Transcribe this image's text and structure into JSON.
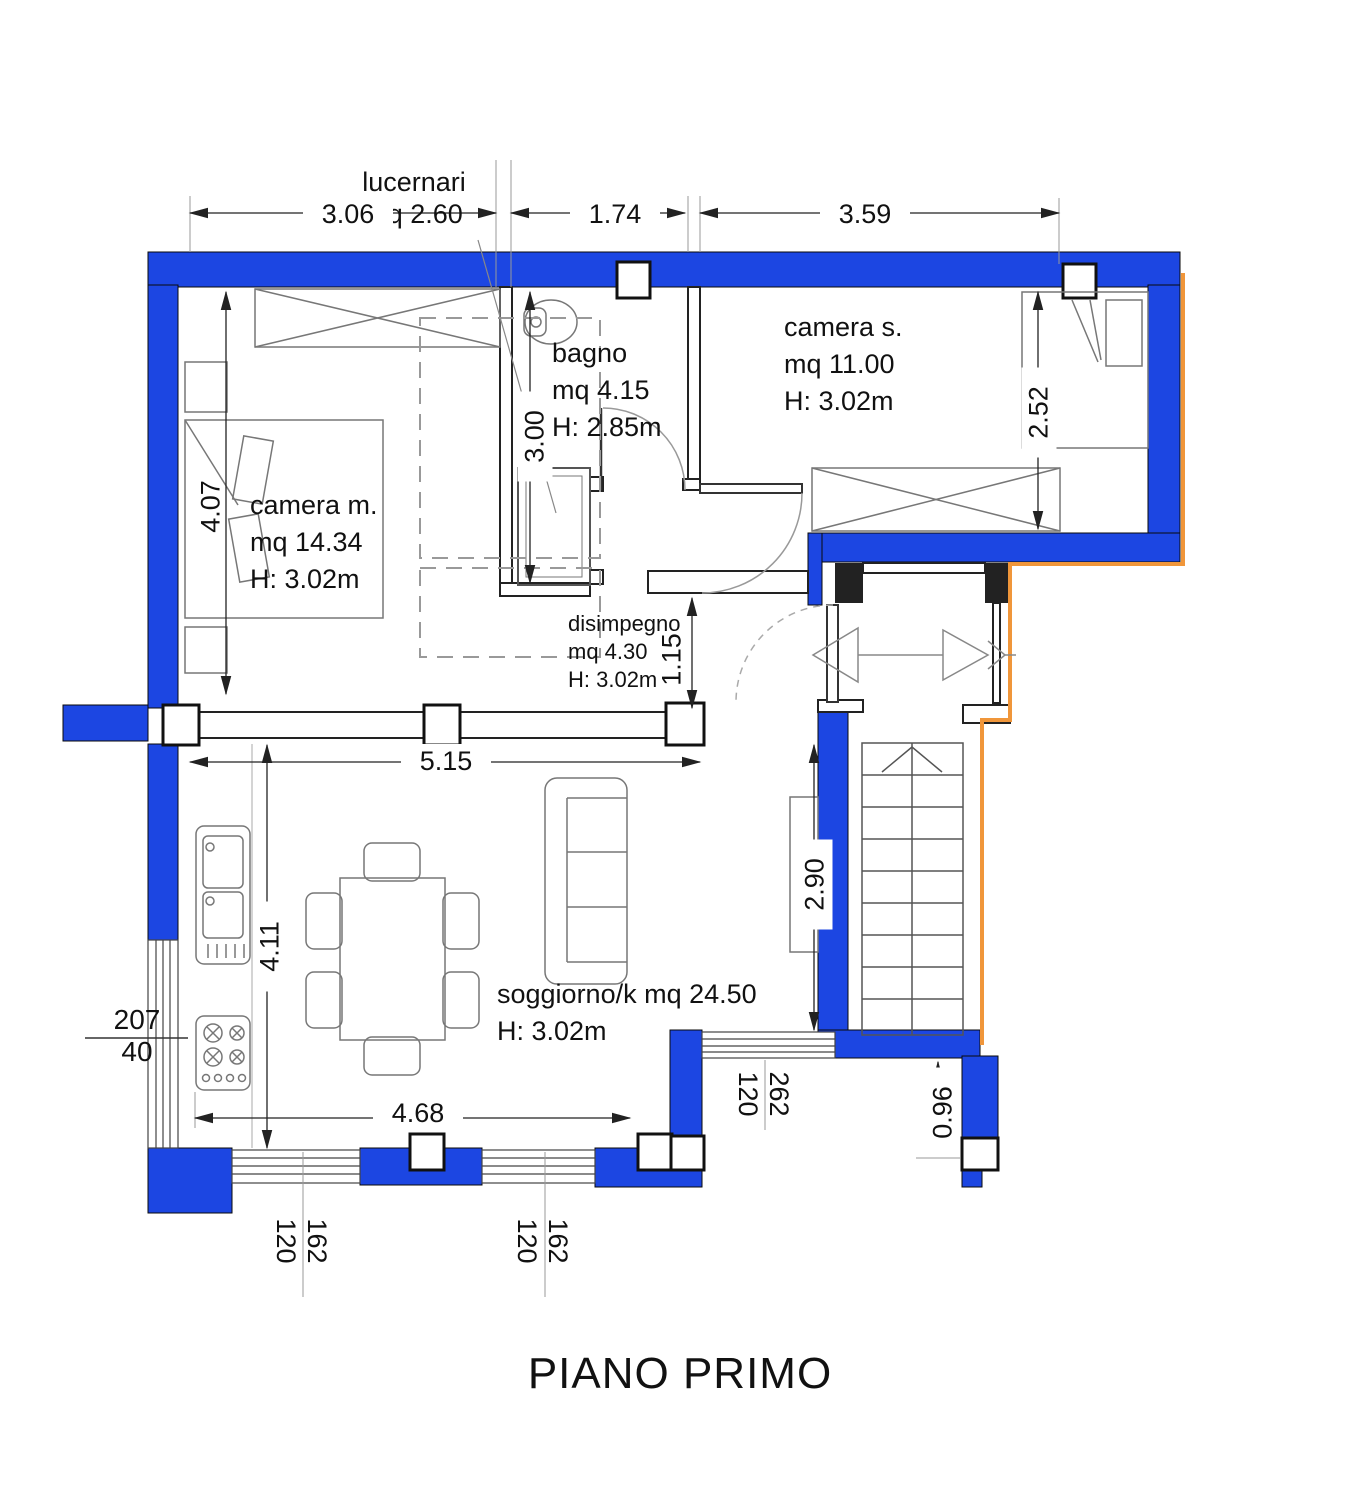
{
  "title": "PIANO PRIMO",
  "colors": {
    "wall_blue": "#1c46e2",
    "boundary_orange": "#f0963a",
    "line": "#222222"
  },
  "annotations": {
    "skylight_label_line1": "lucernari",
    "skylight_label_line2": "mq 2.60"
  },
  "rooms": {
    "camera_m": {
      "name": "camera m.",
      "area": "mq 14.34",
      "height": "H: 3.02m"
    },
    "bagno": {
      "name": "bagno",
      "area": "mq 4.15",
      "height": "H: 2.85m"
    },
    "camera_s": {
      "name": "camera s.",
      "area": "mq 11.00",
      "height": "H: 3.02m"
    },
    "disimpegno": {
      "name": "disimpegno",
      "area": "mq 4.30",
      "height": "H: 3.02m"
    },
    "soggiorno": {
      "name": "soggiorno/k mq 24.50",
      "height": "H: 3.02m"
    }
  },
  "dimensions": {
    "top_left": "3.06",
    "top_mid": "1.74",
    "top_right": "3.59",
    "camera_m_depth": "4.07",
    "bagno_depth": "3.00",
    "camera_s_depth": "2.52",
    "hall_depth": "1.15",
    "living_width": "5.15",
    "stair_side": "2.90",
    "living_depth": "4.11",
    "living_bottom": "4.68",
    "balcony_depth": "0.96"
  },
  "windows": {
    "left": {
      "width": "207",
      "sill": "40"
    },
    "bottom_1": {
      "width": "162",
      "sill": "120"
    },
    "bottom_2": {
      "width": "162",
      "sill": "120"
    },
    "balcony": {
      "width": "262",
      "sill": "120"
    }
  }
}
